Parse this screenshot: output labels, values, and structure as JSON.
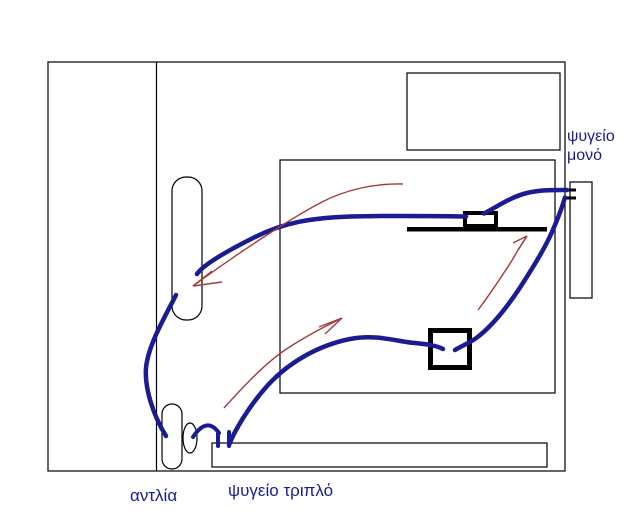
{
  "diagram": {
    "type": "hand-drawn plumbing/refrigeration schematic (paint-style)",
    "labels": {
      "single_fridge": "ψυγείο μονό",
      "pump": "αντλία",
      "triple_fridge": "ψυγείο τριπλό"
    },
    "colors": {
      "pipe_blue": "#1b1b93",
      "arrow_red": "#a03c3c",
      "outline_black": "#000000",
      "label_blue": "#1b1b93",
      "background": "#ffffff"
    }
  }
}
